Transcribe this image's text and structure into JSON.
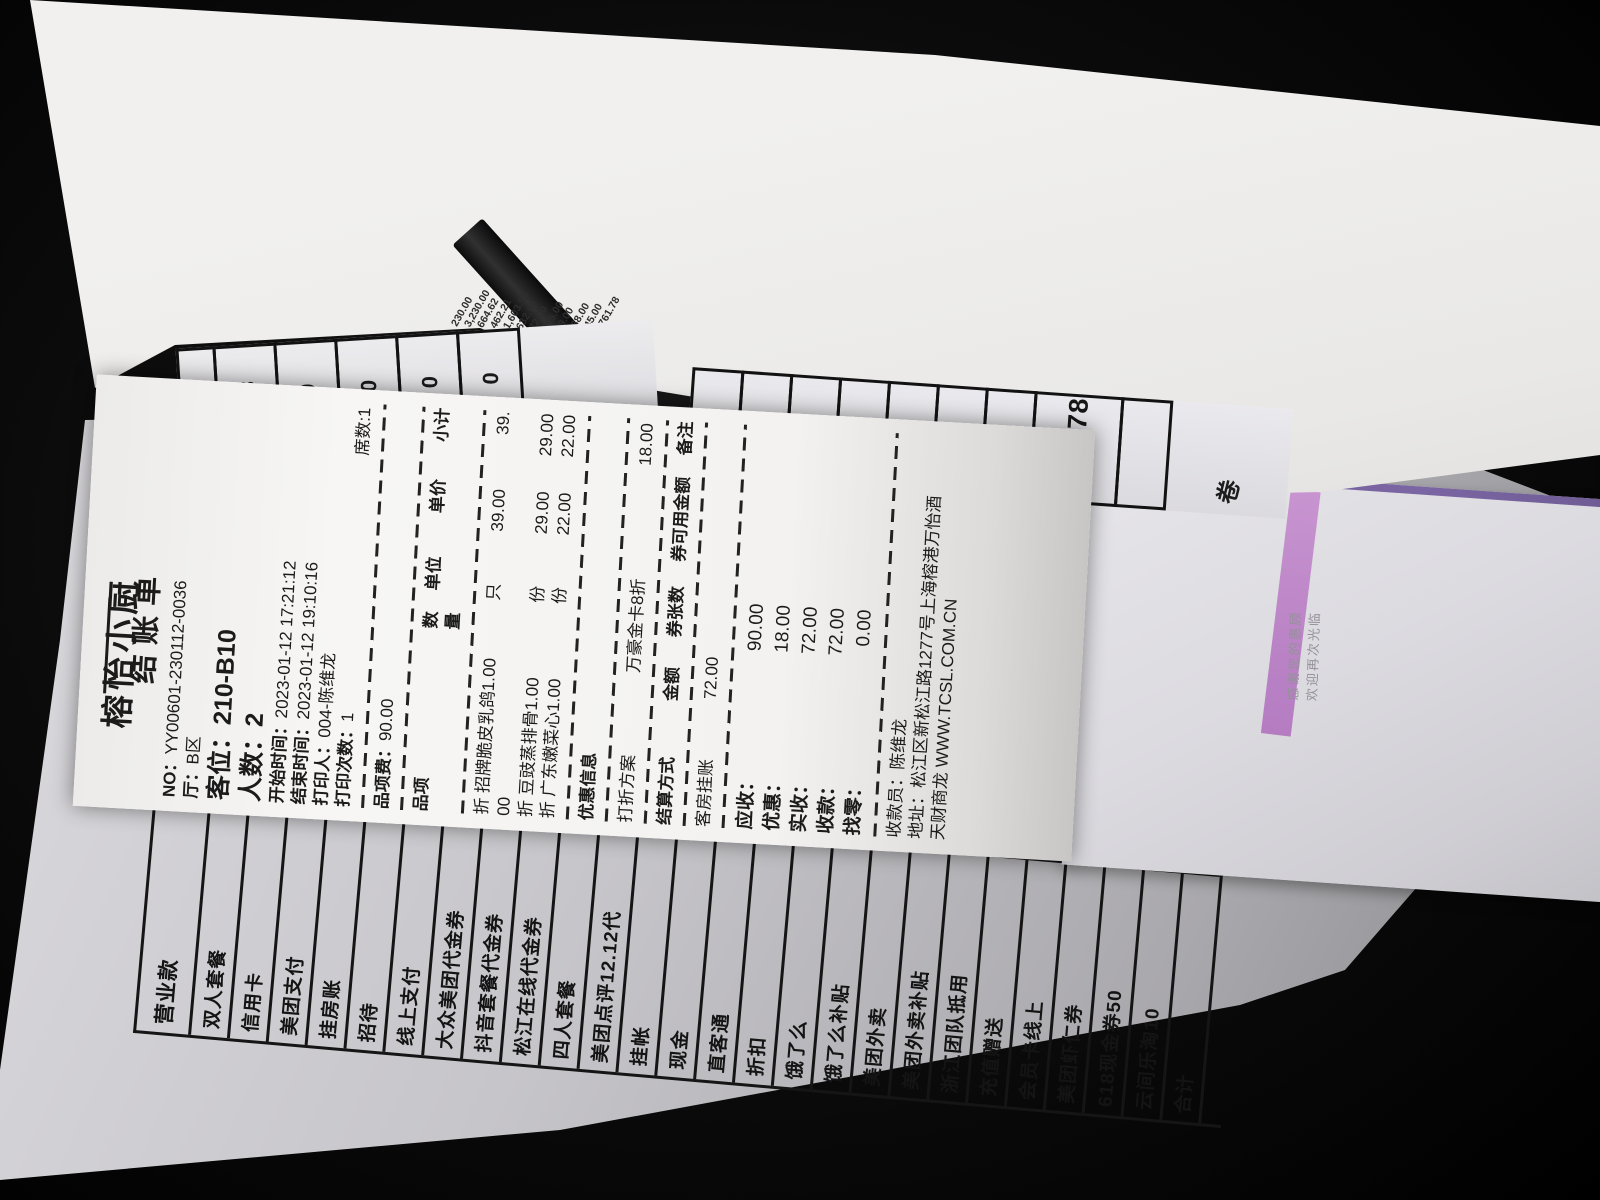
{
  "receipt": {
    "title": "榕怡小厨",
    "subtitle": "结账单",
    "info": {
      "no_label": "NO：",
      "no": "YY00601-230112-0036",
      "hall_label": "厅：",
      "hall": "B区",
      "table_label": "客位：",
      "table": "210-B10",
      "guests_label": "人数：",
      "guests": "2",
      "start_label": "开始时间：",
      "start": "2023-01-12 17:21:12",
      "end_label": "结束时间：",
      "end": "2023-01-12 19:10:16",
      "printer_label": "打印人：",
      "printer": "004-陈维龙",
      "print_count_label": "打印次数：",
      "print_count": "1",
      "seat_count": "席数:1"
    },
    "item_fee_label": "品项费：",
    "item_fee": "90.00",
    "items_header": [
      "品项",
      "数量",
      "单位",
      "单价",
      "小计"
    ],
    "items": {
      "0": {
        "name": "折 招牌脆皮乳鸽",
        "qty": "1.00",
        "unit": "只",
        "price": "39.00",
        "subtotal_first": "39.",
        "subtotal_wrap": "00"
      },
      "1": {
        "name": "折 豆豉蒸排骨",
        "qty": "1.00",
        "unit": "份",
        "price": "29.00",
        "subtotal": "29.00"
      },
      "2": {
        "name": "折 广东嫩菜心",
        "qty": "1.00",
        "unit": "份",
        "price": "22.00",
        "subtotal": "22.00"
      }
    },
    "promo_header": "优惠信息",
    "discount": {
      "label": "打折方案",
      "name": "万豪金卡8折",
      "amount": "18.00"
    },
    "settle_header": [
      "结算方式",
      "金额",
      "券张数",
      "券可用金额",
      "备注"
    ],
    "settle_row": {
      "method": "客房挂账",
      "amount": "72.00"
    },
    "totals": {
      "0": {
        "label": "应收：",
        "value": "90.00"
      },
      "1": {
        "label": "优惠：",
        "value": "18.00"
      },
      "2": {
        "label": "实收：",
        "value": "72.00"
      },
      "3": {
        "label": "收款：",
        "value": "72.00"
      },
      "4": {
        "label": "找零：",
        "value": "0.00"
      }
    },
    "cashier_label": "收款员：",
    "cashier": "陈维龙",
    "address_label": "地址：",
    "address": "松江区新松江路1277号上海榕港万怡酒",
    "vendor": "天财商龙 WWW.TCSL.COM.CN"
  },
  "report": {
    "header": "营业款",
    "rows": [
      "双人套餐",
      "信用卡",
      "美团支付",
      "挂房账",
      "招待",
      "线上支付",
      "大众美团代金券",
      "抖音套餐代金券",
      "松江在线代金券",
      "四人套餐",
      "美团点评12.12代",
      "挂帐",
      "现金",
      "直客通",
      "折扣",
      "饿了么",
      "饿了么补贴",
      "美团外卖",
      "美团外卖补贴",
      "浙江团队抵用",
      "充值赠送",
      "会员卡线上",
      "美团虾仁券",
      "618现金券50",
      "云间乐淘10",
      "合计"
    ],
    "next_column_text": "双人",
    "amounts": [
      "230.00",
      "3,230.00",
      "664.62",
      "462.21",
      "1,603.95",
      "632.00",
      "72.00",
      "155.00",
      "99.00",
      "168.00",
      "445.00",
      "7,761.78"
    ],
    "digit_cells": [
      "78",
      "0",
      "0",
      "0",
      "0"
    ],
    "total_box": "7761.78",
    "stamp": "卷"
  },
  "envelope": {
    "thanks_line1": "感谢您的惠顾",
    "thanks_line2": "欢迎再次光临"
  },
  "colors": {
    "envelope_top_line": "#6d5a92",
    "envelope_stripe": "#bb84c6",
    "receipt_paper": "#f3f2f0",
    "report_paper": "#c6c5c9",
    "ink": "#1b1b1b",
    "background": "#000000"
  }
}
